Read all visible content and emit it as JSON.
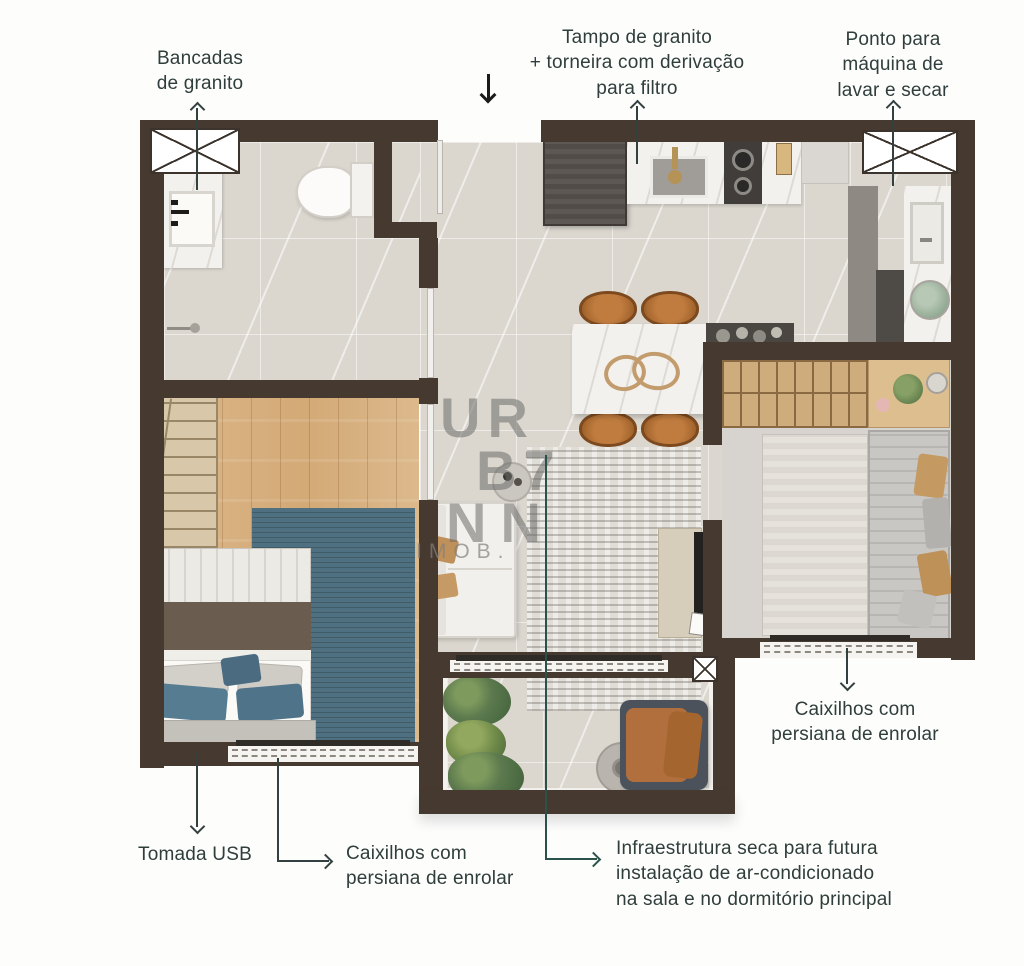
{
  "watermark": {
    "lines": [
      "UR",
      "B7",
      "NN"
    ],
    "subtext": "IMOB."
  },
  "entrance_arrow": {
    "icon": "chevron-down"
  },
  "annotations": {
    "bancadas": {
      "lines": [
        "Bancadas",
        "de granito"
      ],
      "arrow": "up"
    },
    "tampo": {
      "lines": [
        "Tampo de granito",
        "+ torneira com derivação",
        "para filtro"
      ],
      "arrow": "up"
    },
    "ponto": {
      "lines": [
        "Ponto para",
        "máquina de",
        "lavar e secar"
      ],
      "arrow": "up"
    },
    "caixilhos_right": {
      "lines": [
        "Caixilhos com",
        "persiana de enrolar"
      ],
      "arrow": "down"
    },
    "tomada_usb": {
      "lines": [
        "Tomada USB"
      ],
      "arrow": "down"
    },
    "caixilhos_bottom": {
      "lines": [
        "Caixilhos com",
        "persiana de enrolar"
      ],
      "arrow": "right"
    },
    "infraestrutura": {
      "lines": [
        "Infraestrutura seca para futura",
        "instalação de ar-condicionado",
        "na sala e no dormitório principal"
      ],
      "arrow": "right"
    }
  },
  "colors": {
    "wall": "#463930",
    "label_text": "#2f3e3c",
    "leader_line": "#32413f",
    "floor_tile": "#dbd7cf",
    "wood_floor": "#d8b082",
    "teal_rug": "#4e7080",
    "leather": "#ad6c38",
    "granite_counter": "#f3f1ed"
  }
}
